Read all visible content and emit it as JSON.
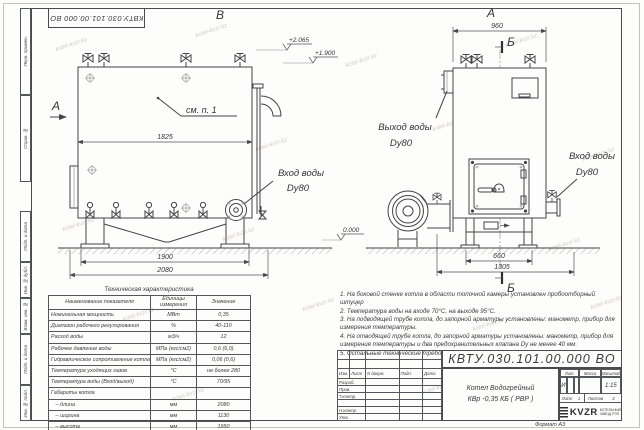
{
  "doc_number": "КВТУ.030.101.00.000  ВО",
  "watermark": "kotel-kvzr.kz",
  "margin": {
    "cells": [
      "Перв. примен.",
      "Справ. №",
      "Подп. и дата",
      "Инв. № дубл.",
      "Взам. инв. №",
      "Подп. и дата",
      "Инв. № подл."
    ]
  },
  "views": {
    "view_b": "В",
    "view_a": "А",
    "section_b": "Б",
    "see_note": "см. п. 1",
    "elev_2065": "+2.065",
    "elev_1900": "+1.900",
    "elev_0": "0.000",
    "dim_1825": "1825",
    "dim_1900": "1900",
    "dim_2080": "2080",
    "dim_960": "960",
    "dim_660": "660",
    "dim_1305": "1305",
    "inlet_label_1": "Вход воды",
    "inlet_label_2": "Dy80",
    "outlet_label_1": "Выход воды",
    "outlet_label_2": "Dy80"
  },
  "tech_table": {
    "title": "Техническая характеристика",
    "headers": [
      "Наименование показателя",
      "Единицы измерения",
      "Значение"
    ],
    "rows": [
      [
        "Номинальная мощность",
        "МВт",
        "0,35"
      ],
      [
        "Диапазон рабочего регулирования",
        "%",
        "40-110"
      ],
      [
        "Расход воды",
        "м3/ч",
        "12"
      ],
      [
        "Рабочее давление воды",
        "МПа (кгс/см2)",
        "0,6 (6,0)"
      ],
      [
        "Гидравлическое сопротивление котла",
        "МПа (кгс/см2)",
        "0,06 (0,6)"
      ],
      [
        "Температура уходящих газов",
        "°С",
        "не более 280"
      ],
      [
        "Температура воды (Вход/выход)",
        "°С",
        "70/95"
      ],
      [
        "Габариты котла",
        "",
        ""
      ],
      [
        "   – длина",
        "мм",
        "2080"
      ],
      [
        "   – ширина",
        "мм",
        "1130"
      ],
      [
        "   – высота",
        "мм",
        "1950"
      ]
    ]
  },
  "notes": [
    "1.  На боковой стенке котла в области топочной камеры установлен пробоотборный штуцер",
    "2.  Температура воды на входе 70°С, на выходе 95°С.",
    "3.  На подводящей трубе котла, до запорной арматуры установлены: манометр, прибор для измерения температуры.",
    "4.  На отводящей трубе котла, до запорной арматуры установлены: манометр, прибор для измерения температуры и два предохранительных клапана  Dу не менее 40 мм.",
    "5.  Остальные технические требования по ОСТ 108.030.133-84."
  ],
  "title_block": {
    "header_cols": [
      "Изм.",
      "Лист",
      "N докум.",
      "Подп.",
      "Дата"
    ],
    "row_labels": [
      "Разраб.",
      "Пров.",
      "Т.контр.",
      "",
      "Н.контр.",
      "Утв."
    ],
    "product_name_1": "Котел Водогрейный",
    "product_name_2": "КВр -0,35  КБ  ( РВР )",
    "lit_label": "Лит.",
    "mass_label": "Масса",
    "scale_label": "Масштаб",
    "lit_value": "И",
    "scale_value": "1:15",
    "sheet_label": "Лист",
    "sheet_value": "1",
    "sheets_label": "Листов",
    "sheets_value": "2",
    "logo_word": "KVZR",
    "logo_cap_1": "КОТЕЛЬНЫЙ",
    "logo_cap_2": "ЗАВОД РЭП",
    "format_text": "Формат    А3"
  }
}
